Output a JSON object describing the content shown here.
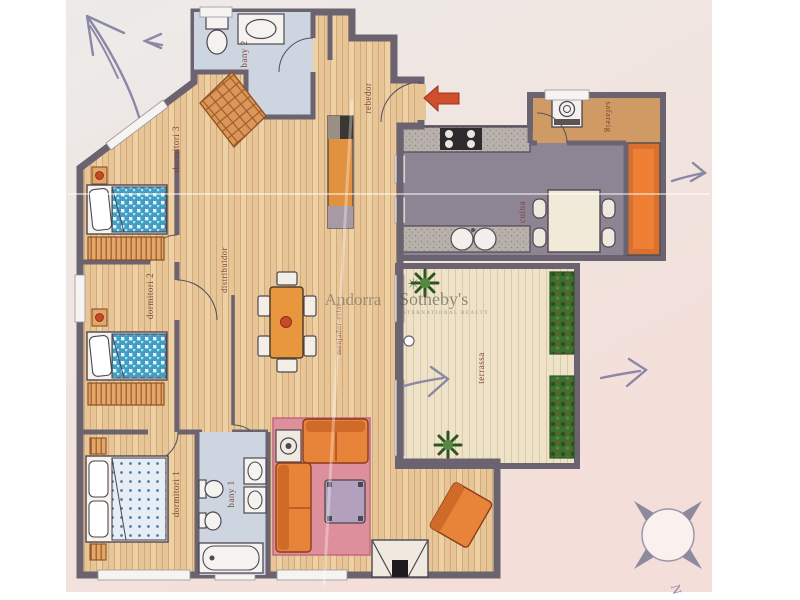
{
  "watermark": {
    "left": "Andorra",
    "brand": "Sotheby's",
    "sub": "INTERNATIONAL REALTY",
    "flower_glyph": "✳"
  },
  "rooms": {
    "bany2": "bany 2",
    "rebedor": "rebedor",
    "dormitori3": "dormitori 3",
    "dormitori2": "dormitori 2",
    "distribuidor": "distribuidor",
    "menjador_estar": "menjador-estar",
    "dormitori1": "dormitori 1",
    "bany1": "bany 1",
    "cuina": "cuina",
    "safareig": "safareig",
    "terrassa": "terrassa"
  },
  "compass": {
    "letter": "N"
  },
  "colors": {
    "wall": "#6b6370",
    "wood_floor": "#e7c596",
    "bath_floor": "#cdd6e0",
    "kitchen_floor": "#8d8494",
    "terrace_floor": "#eee3c9",
    "laundry_floor": "#cf9a63",
    "furniture_orange": "#e8833a",
    "rug_pink": "#dd8f9c",
    "bed_blue": "#3f9fc6",
    "plant_green": "#3f6e2e",
    "entrance_arrow_red": "#ce4e2d",
    "pencil": "#8a88a6",
    "label_text": "#7d4336"
  }
}
